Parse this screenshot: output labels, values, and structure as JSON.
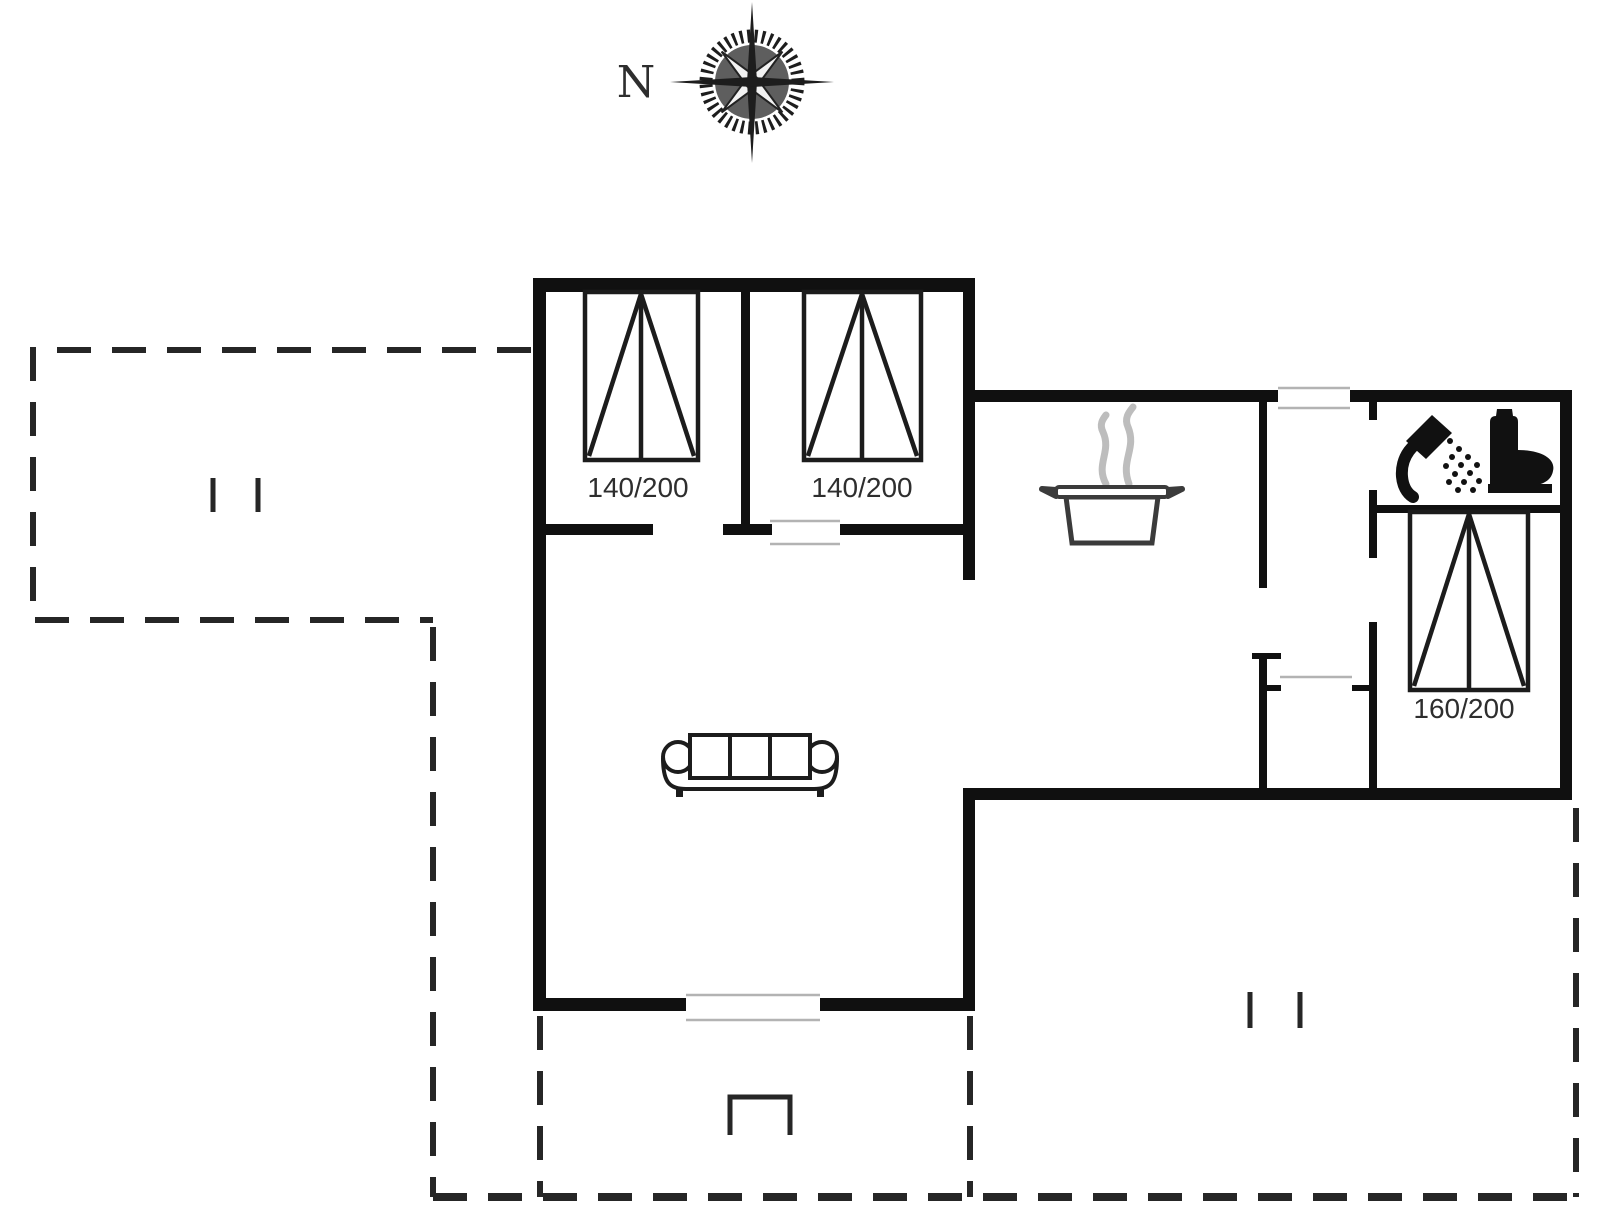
{
  "page": {
    "background": "#ffffff"
  },
  "compass": {
    "label": "N"
  },
  "rooms": {
    "bedroom1": {
      "bed_label": "140/200"
    },
    "bedroom2": {
      "bed_label": "140/200"
    },
    "bedroom3": {
      "bed_label": "160/200"
    }
  },
  "icons": {
    "compass": "compass-rose-icon",
    "kitchen": "cooking-pot-icon",
    "bathroom": [
      "shower-icon",
      "toilet-icon"
    ],
    "living_room": "sofa-icon",
    "terrace": "table-icon"
  },
  "colors": {
    "wall": "#101010",
    "furniture_line": "#1c1c1c",
    "door_line": "#b3b3b3",
    "dash_line": "#262626",
    "label_text": "#2e2e2e",
    "steam": "#bdbdbd",
    "icon_fill": "#111111",
    "compass_disk": "#5e5e5e",
    "compass_needle": "#1d1d1d"
  }
}
